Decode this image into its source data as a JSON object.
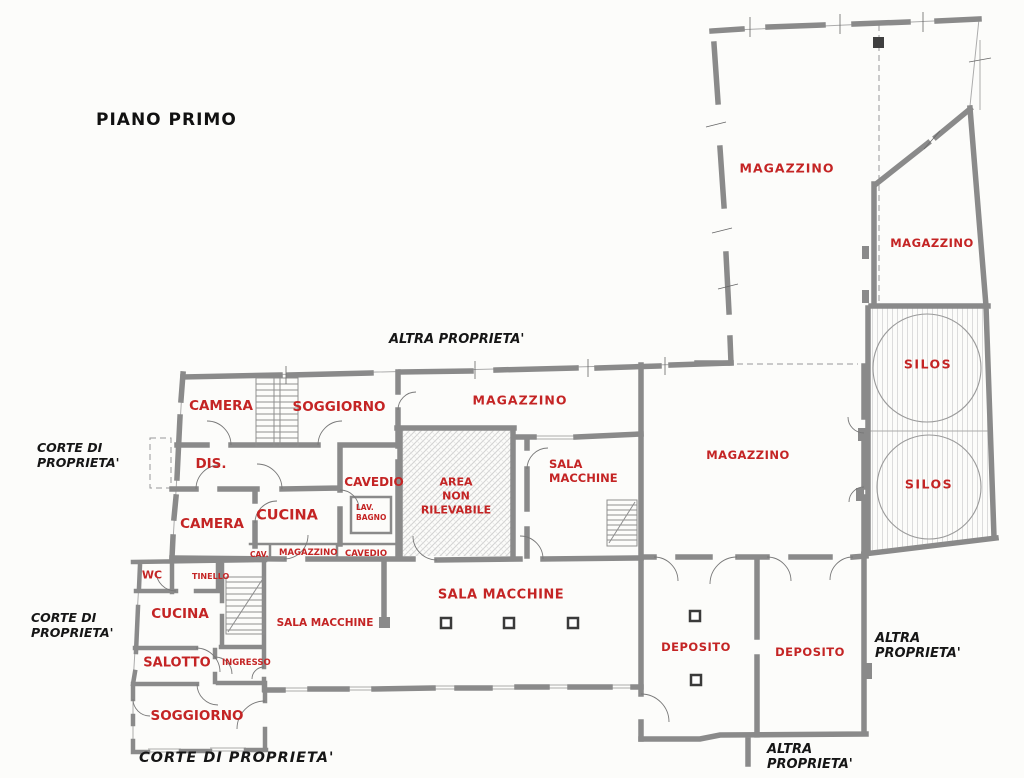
{
  "plan": {
    "title": "PIANO PRIMO",
    "type_note": "architectural first-floor plan, scanned style"
  },
  "colors": {
    "room_label": "#c42424",
    "property_label": "#161616",
    "wall": "#8a8a8a"
  },
  "labels": {
    "title": "PIANO PRIMO",
    "altra_proprieta_top": "ALTRA PROPRIETA'",
    "corte_di_proprieta_west_upper": "CORTE DI\nPROPRIETA'",
    "corte_di_proprieta_west_lower": "CORTE DI\nPROPRIETA'",
    "altra_proprieta_east": "ALTRA\nPROPRIETA'",
    "altra_proprieta_south": "ALTRA\nPROPRIETA'",
    "corte_di_proprieta_south": "CORTE DI PROPRIETA'",
    "magazzino_north": "MAGAZZINO",
    "magazzino_northeast": "MAGAZZINO",
    "silos_upper": "SILOS",
    "silos_lower": "SILOS",
    "magazzino_center": "MAGAZZINO",
    "magazzino_east": "MAGAZZINO",
    "camera_upper": "CAMERA",
    "soggiorno_upper": "SOGGIORNO",
    "dis": "DIS.",
    "cavedio": "CAVEDIO",
    "cucina_upper": "CUCINA",
    "lav_bagno": "LAV.\nBAGNO",
    "camera_lower": "CAMERA",
    "area_non_rilevabile": "AREA\nNON\nRILEVABILE",
    "sala_macchine_upper": "SALA\nMACCHINE",
    "cav_small": "CAV.",
    "magazzino_small": "MAGAZZINO",
    "cavedio_small": "CAVEDIO",
    "wc": "WC",
    "tinello": "TINELLO",
    "cucina_lower": "CUCINA",
    "salotto": "SALOTTO",
    "ingresso": "INGRESSO",
    "sala_macchine_west": "SALA MACCHINE",
    "sala_macchine_center": "SALA MACCHINE",
    "deposito_west": "DEPOSITO",
    "deposito_east": "DEPOSITO",
    "soggiorno_lower": "SOGGIORNO"
  }
}
